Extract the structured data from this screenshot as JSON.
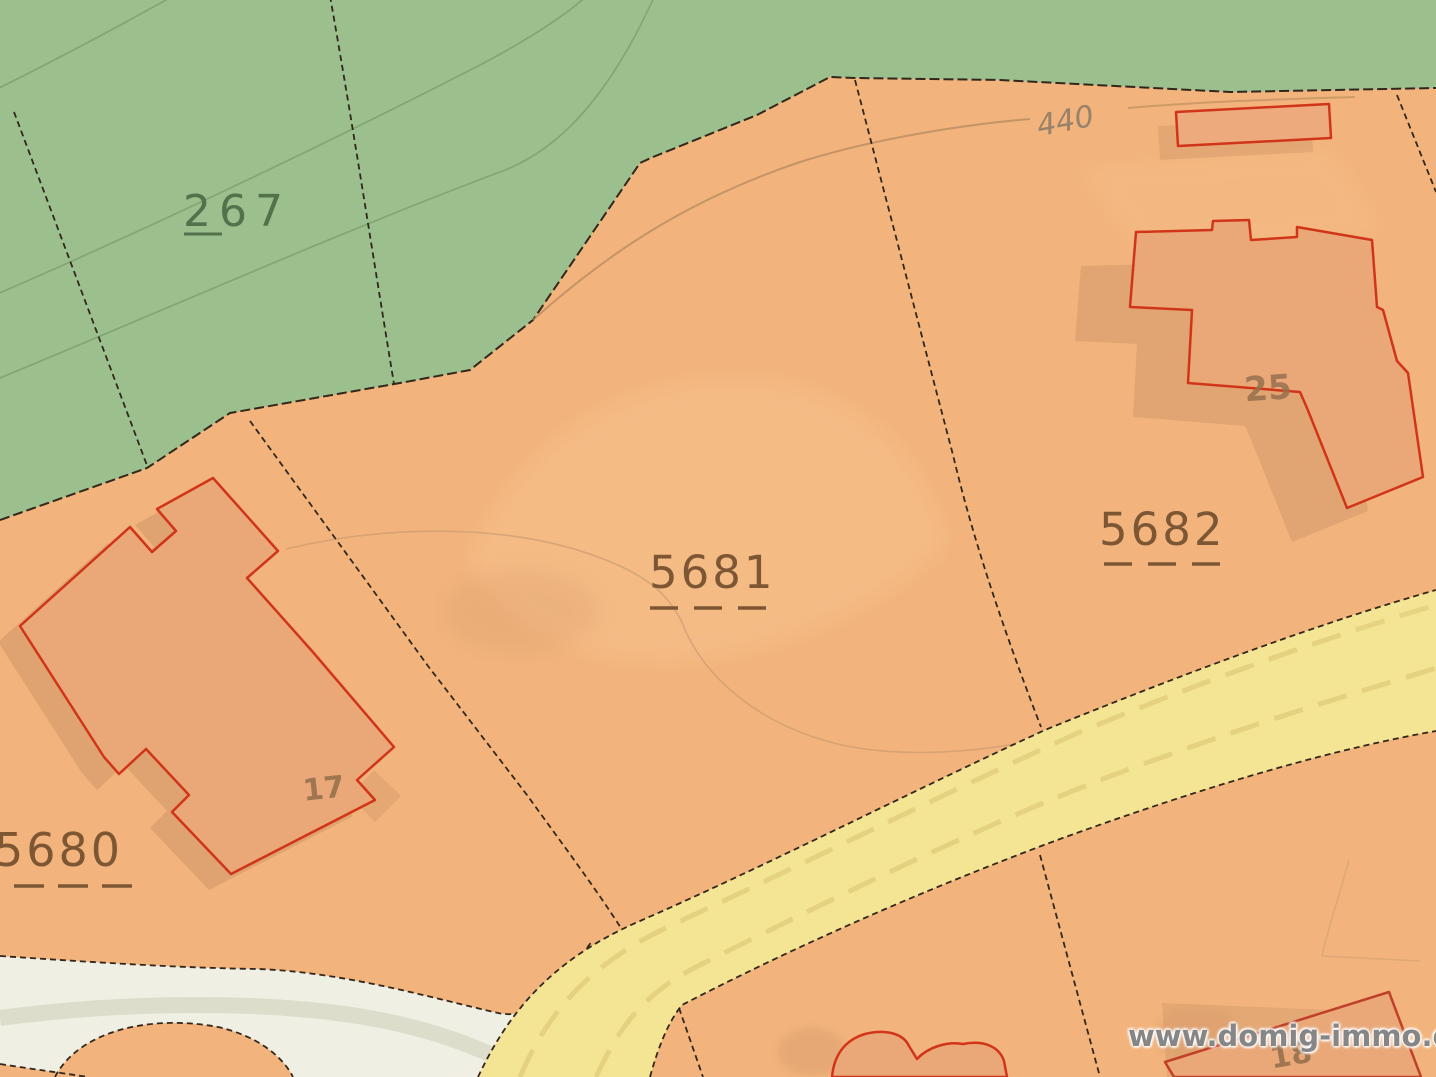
{
  "map": {
    "title": "Cadastral parcel map extract",
    "watermark": "www.domig-immo.eu",
    "contour_label_440": "440",
    "parcel_labels": {
      "p267": "267",
      "p5680": "5680",
      "p5681": "5681",
      "p5682": "5682"
    },
    "house_numbers": {
      "h17": "17",
      "h25": "25",
      "h18": "18"
    },
    "colors": {
      "forest_green": "#9bbf8d",
      "contour_green": "#7fa471",
      "building_land_orange": "#f2b47c",
      "building_fill": "#eaa878",
      "building_outline_red": "#d13519",
      "shadow_brown": "#d0966a",
      "road_yellow": "#f3e594",
      "road_marking_yellow": "#e4d180",
      "road_white": "#f0efe3",
      "road_stripe_grey": "#dbdbca",
      "boundary_black": "#32271c",
      "contour_brown": "#b5895f",
      "driveway_brown": "#c79a70",
      "label_brown": "#7d5634",
      "label_green": "#53714b",
      "house_number_brown": "#97704e",
      "watermark_grey": "#868686"
    }
  }
}
